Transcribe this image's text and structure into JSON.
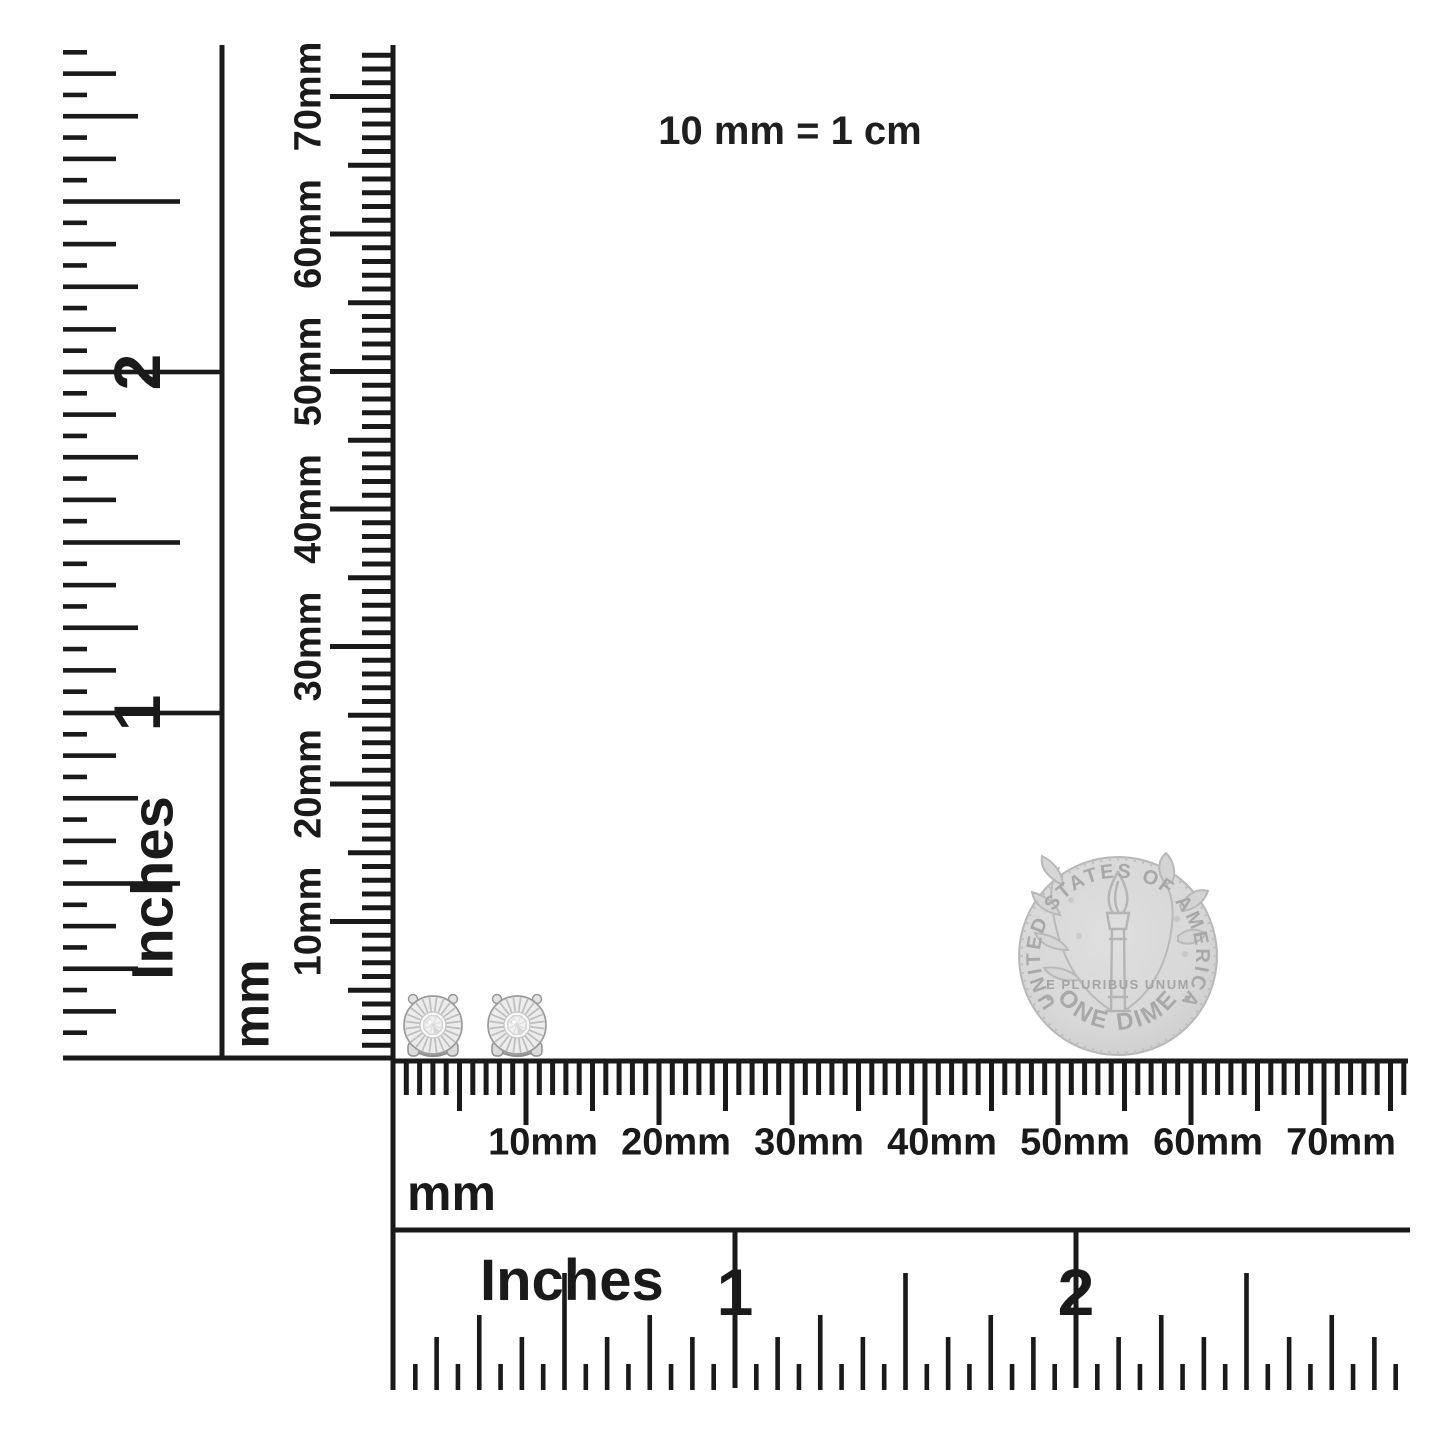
{
  "caption": "10 mm = 1 cm",
  "rulers": {
    "vertical_inches": {
      "unit": "Inches",
      "numerals": [
        "1",
        "2"
      ]
    },
    "vertical_mm": {
      "unit": "mm",
      "labels": [
        "10mm",
        "20mm",
        "30mm",
        "40mm",
        "50mm",
        "60mm",
        "70mm"
      ]
    },
    "horizontal_mm": {
      "unit": "mm",
      "labels": [
        "10mm",
        "20mm",
        "30mm",
        "40mm",
        "50mm",
        "60mm",
        "70mm"
      ]
    },
    "horizontal_inches": {
      "unit": "Inches",
      "numerals": [
        "1",
        "2"
      ]
    }
  },
  "coin": {
    "legend_top": "UNITED STATES OF AMERICA",
    "motto": "E PLURIBUS UNUM",
    "denomination": "ONE DIME"
  },
  "earrings": {
    "count": 2
  },
  "colors": {
    "ink": "#1a1a1a",
    "coin_fill": "#d8d8d8",
    "coin_line": "#b2b2b2",
    "coin_text": "#a4a4a4",
    "earring_metal": "#ececec",
    "earring_line": "#9a9a9a"
  }
}
